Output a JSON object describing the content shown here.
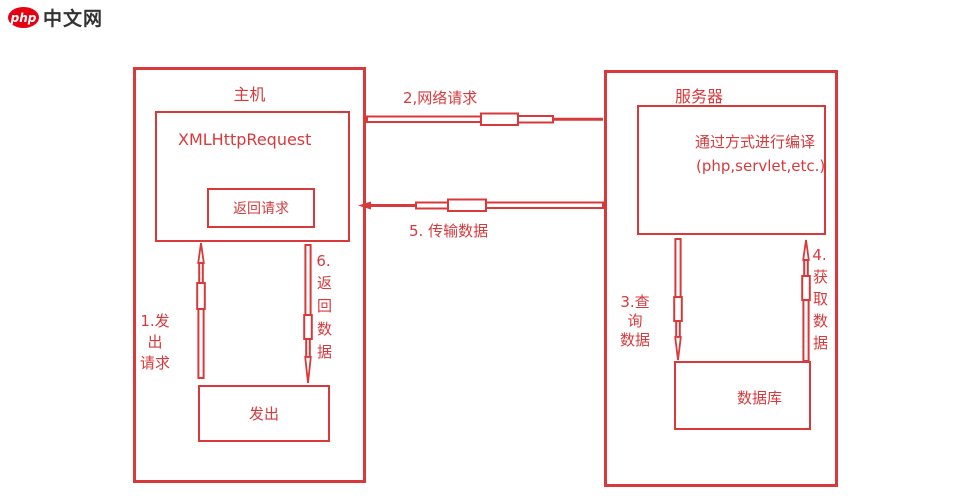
{
  "colors": {
    "red": "#d83a3c",
    "logo_red": "#e50012",
    "logo_text": "#333333"
  },
  "logo": {
    "badge": "php",
    "text": "中文网"
  },
  "host": {
    "title": "主机",
    "xhr_label": "XMLHttpRequest",
    "return_request_label": "返回请求",
    "send_label": "发出",
    "send_request_label": {
      "line1": "1.发出",
      "line2": "请求"
    },
    "return_data_label": {
      "number": "6.",
      "text": "返回数据"
    }
  },
  "network": {
    "request_label": "2,网络请求",
    "transfer_label": "5. 传输数据"
  },
  "server": {
    "title": "服务器",
    "compile_label": {
      "line1": "通过方式进行编译",
      "line2": "(php,servlet,etc.)"
    },
    "database_label": "数据库",
    "query_label": {
      "line1": "3.查询",
      "line2": "数据"
    },
    "fetch_label": {
      "number": "4.",
      "text": "获取数据"
    }
  }
}
